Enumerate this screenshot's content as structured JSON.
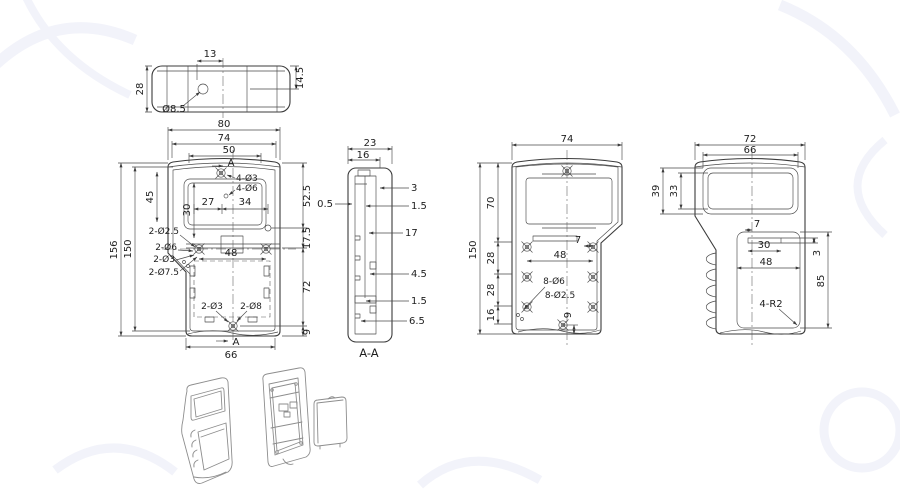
{
  "page": {
    "background": "#ffffff"
  },
  "colors": {
    "line": "#3b3b3b",
    "dim_text": "#1e1e1e",
    "iso_line": "#8d8d8d",
    "watermark": "#f2f3fa"
  },
  "drawing": {
    "top_view": {
      "dim_13": "13",
      "dim_28": "28",
      "dim_14_5": "14.5",
      "hole_label": "Ø8.5"
    },
    "front_view": {
      "dim_80": "80",
      "dim_74": "74",
      "dim_50": "50",
      "dim_156": "156",
      "dim_150": "150",
      "dim_45": "45",
      "dim_30": "30",
      "dim_27": "27",
      "dim_34": "34",
      "dim_48": "48",
      "dim_52_5": "52.5",
      "dim_17_5": "17.5",
      "dim_72": "72",
      "dim_9": "9",
      "dim_66": "66",
      "hole_4_d3": "4-Ø3",
      "hole_4_d6": "4-Ø6",
      "hole_2_d2_5": "2-Ø2.5",
      "hole_2_d6": "2-Ø6",
      "hole_2_d3": "2-Ø3",
      "hole_2_d7_5": "2-Ø7.5",
      "hole_2_d3_bottom": "2-Ø3",
      "hole_2_d8": "2-Ø8",
      "section_marker_top": "A",
      "section_marker_bottom": "A"
    },
    "section_view": {
      "title": "A-A",
      "dim_23": "23",
      "dim_16": "16",
      "dim_3": "3",
      "dim_1_5_upper": "1.5",
      "dim_0_5": "0.5",
      "dim_17": "17",
      "dim_4_5": "4.5",
      "dim_1_5_lower": "1.5",
      "dim_6_5": "6.5"
    },
    "inside_view": {
      "dim_74": "74",
      "dim_150": "150",
      "dim_70": "70",
      "dim_28_upper": "28",
      "dim_28_lower": "28",
      "dim_16": "16",
      "dim_7": "7",
      "dim_48": "48",
      "dim_9": "9",
      "hole_8_d6": "8-Ø6",
      "hole_8_d2_5": "8-Ø2.5"
    },
    "back_view": {
      "dim_72": "72",
      "dim_66": "66",
      "dim_39": "39",
      "dim_33": "33",
      "dim_7": "7",
      "dim_30": "30",
      "dim_48": "48",
      "dim_3": "3",
      "dim_85": "85",
      "corner_label": "4-R2"
    }
  }
}
